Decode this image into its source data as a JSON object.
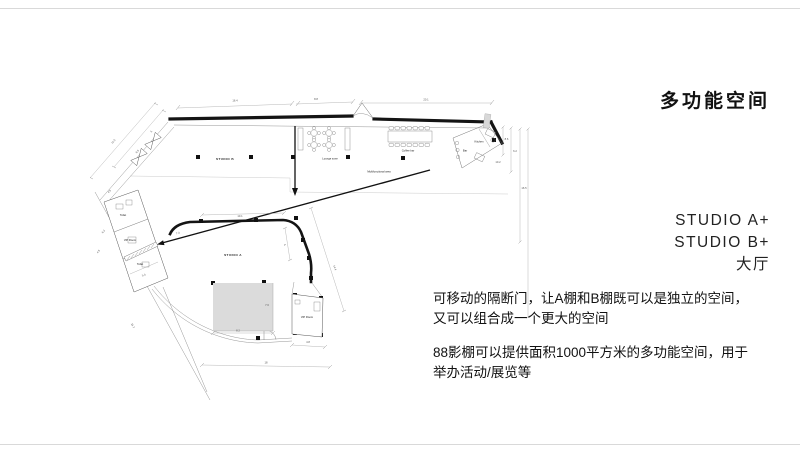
{
  "title": "多功能空间",
  "side_labels": {
    "line1": "STUDIO A+",
    "line2": "STUDIO B+",
    "line3": "大厅"
  },
  "description": {
    "p1_line1": "可移动的隔断门，让A棚和B棚既可以是独立的空间，",
    "p1_line2": "又可以组合成一个更大的空间",
    "p2_line1": "88影棚可以提供面积1000平方米的多功能空间，用于",
    "p2_line2": "举办活动/展览等"
  },
  "plan": {
    "labels": {
      "studio_b": "STUDIO B",
      "studio_a": "STUDIO A",
      "lounge": "Lounge zone",
      "coffee_bar": "Coffee bar",
      "multifunctional": "Multifunctional area",
      "kitchen": "Kitchen",
      "bar": "Bar",
      "toilet_upper": "Toilet",
      "vip_left": "VIP Room",
      "toilet_lower": "Toilet",
      "vip_bottom": "VIP Room"
    },
    "dims": {
      "top_left": "16.4",
      "top_mid": "8.8",
      "top_right": "20.1",
      "left_a": "11.5",
      "left_b": "8.5",
      "left_c": "5",
      "left_d": "4.5",
      "left_e": "6.2",
      "left_f": "4.5",
      "left_g": "5.3",
      "left_h": "16.7",
      "mid_a": "10.1",
      "mid_b": "4",
      "mid_c": "14.4",
      "mid_d": "7.3",
      "right_a": "8.6",
      "right_b": "6.2",
      "right_c": "10.2",
      "right_d": "16.5",
      "stage_a": "7.6",
      "stage_b": "8.2",
      "bottom_a": "4.8",
      "bottom_b": "18"
    }
  },
  "colors": {
    "ink": "#141414",
    "dim": "#666666",
    "stage_fill": "#dbdbdb",
    "rule": "#d9d9d9"
  }
}
